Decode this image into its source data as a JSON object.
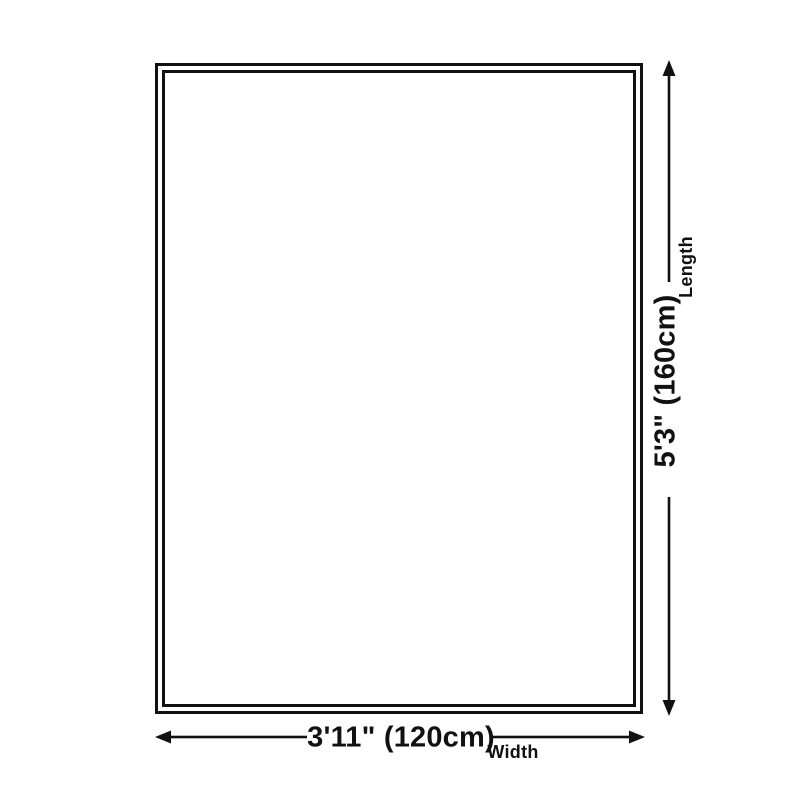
{
  "diagram": {
    "length": {
      "value": "5'3\" (160cm)",
      "label": "Length"
    },
    "width": {
      "value": "3'11\" (120cm)",
      "label": "Width"
    },
    "colors": {
      "ink": "#111111",
      "background": "#ffffff"
    }
  }
}
